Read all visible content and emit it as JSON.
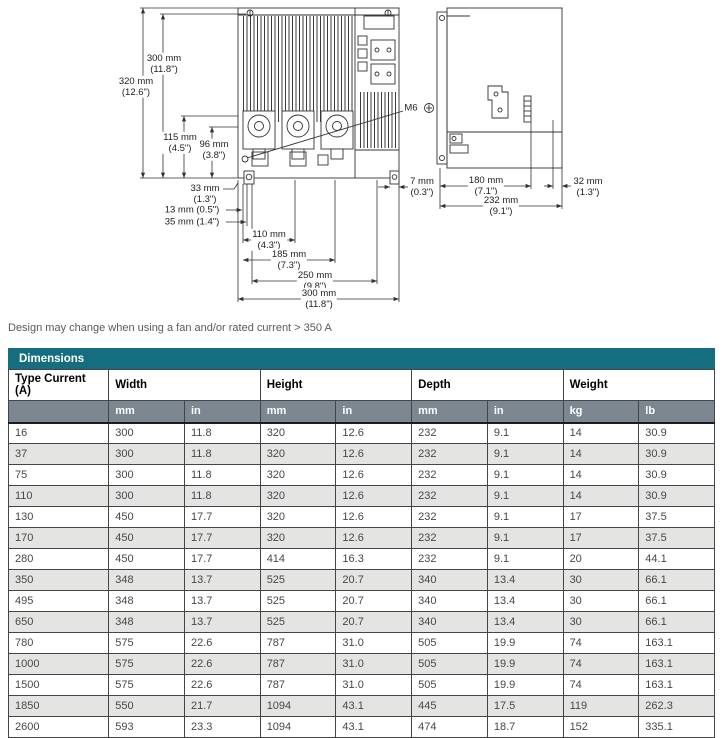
{
  "colors": {
    "accent_teal": "#146e80",
    "subheader_gray": "#7c8791",
    "stripe_gray": "#e4e4e3",
    "line_color": "#333333"
  },
  "diagram": {
    "dims": {
      "d320": "320 mm\n(12.6\")",
      "d300v": "300 mm\n(11.8\")",
      "d115": "115 mm\n(4.5\")",
      "d96": "96 mm\n(3.8\")",
      "d33": "33 mm\n(1.3\")",
      "d13": "13 mm (0.5\")",
      "d35": "35 mm (1.4\")",
      "d110": "110 mm\n(4.3\")",
      "d185": "185 mm\n(7.3\")",
      "d250": "250 mm\n(9.8\")",
      "d300b": "300 mm\n(11.8\")",
      "d7": "7 mm\n(0.3\")",
      "d180": "180 mm\n(7.1\")",
      "d32": "32 mm\n(1.3\")",
      "d232": "232 mm\n(9.1\")",
      "m6": "M6"
    }
  },
  "note": "Design may change when using a fan and/or rated current > 350 A",
  "table": {
    "title": "Dimensions",
    "col_groups": [
      {
        "label": "Type Current (A)",
        "units": []
      },
      {
        "label": "Width",
        "units": [
          "mm",
          "in"
        ]
      },
      {
        "label": "Height",
        "units": [
          "mm",
          "in"
        ]
      },
      {
        "label": "Depth",
        "units": [
          "mm",
          "in"
        ]
      },
      {
        "label": "Weight",
        "units": [
          "kg",
          "lb"
        ]
      }
    ],
    "rows": [
      [
        "16",
        "300",
        "11.8",
        "320",
        "12.6",
        "232",
        "9.1",
        "14",
        "30.9"
      ],
      [
        "37",
        "300",
        "11.8",
        "320",
        "12.6",
        "232",
        "9.1",
        "14",
        "30.9"
      ],
      [
        "75",
        "300",
        "11.8",
        "320",
        "12.6",
        "232",
        "9.1",
        "14",
        "30.9"
      ],
      [
        "110",
        "300",
        "11.8",
        "320",
        "12.6",
        "232",
        "9.1",
        "14",
        "30.9"
      ],
      [
        "130",
        "450",
        "17.7",
        "320",
        "12.6",
        "232",
        "9.1",
        "17",
        "37.5"
      ],
      [
        "170",
        "450",
        "17.7",
        "320",
        "12.6",
        "232",
        "9.1",
        "17",
        "37.5"
      ],
      [
        "280",
        "450",
        "17.7",
        "414",
        "16.3",
        "232",
        "9.1",
        "20",
        "44.1"
      ],
      [
        "350",
        "348",
        "13.7",
        "525",
        "20.7",
        "340",
        "13.4",
        "30",
        "66.1"
      ],
      [
        "495",
        "348",
        "13.7",
        "525",
        "20.7",
        "340",
        "13.4",
        "30",
        "66.1"
      ],
      [
        "650",
        "348",
        "13.7",
        "525",
        "20.7",
        "340",
        "13.4",
        "30",
        "66.1"
      ],
      [
        "780",
        "575",
        "22.6",
        "787",
        "31.0",
        "505",
        "19.9",
        "74",
        "163.1"
      ],
      [
        "1000",
        "575",
        "22.6",
        "787",
        "31.0",
        "505",
        "19.9",
        "74",
        "163.1"
      ],
      [
        "1500",
        "575",
        "22.6",
        "787",
        "31.0",
        "505",
        "19.9",
        "74",
        "163.1"
      ],
      [
        "1850",
        "550",
        "21.7",
        "1094",
        "43.1",
        "445",
        "17.5",
        "119",
        "262.3"
      ],
      [
        "2600",
        "593",
        "23.3",
        "1094",
        "43.1",
        "474",
        "18.7",
        "152",
        "335.1"
      ]
    ]
  }
}
